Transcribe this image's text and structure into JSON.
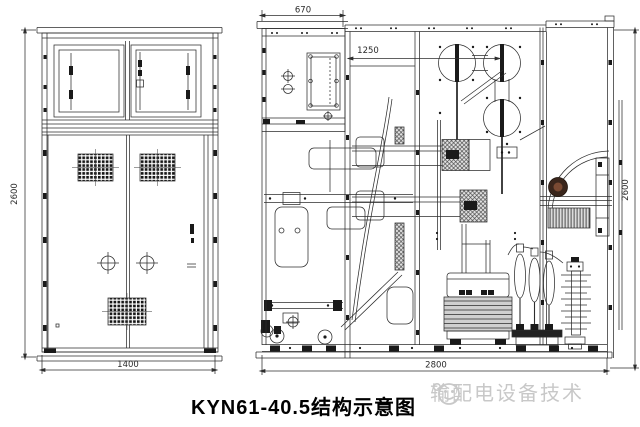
{
  "caption": {
    "text": "KYN61-40.5结构示意图"
  },
  "watermark": {
    "text": "输配电设备技术",
    "logo": "smiley-face-logo",
    "color": "#c8c8c8"
  },
  "front_view": {
    "dim_height": "2600",
    "dim_width": "1400"
  },
  "side_view": {
    "dim_top": "670",
    "dim_inner": "1250",
    "dim_height": "2600",
    "dim_depth": "2800"
  },
  "colors": {
    "line": "#2d2d2d",
    "paper": "#ffffff",
    "dark_component": "#3a261c",
    "rib_fill": "#cfcfcf",
    "watermark": "#c8c8c8"
  }
}
